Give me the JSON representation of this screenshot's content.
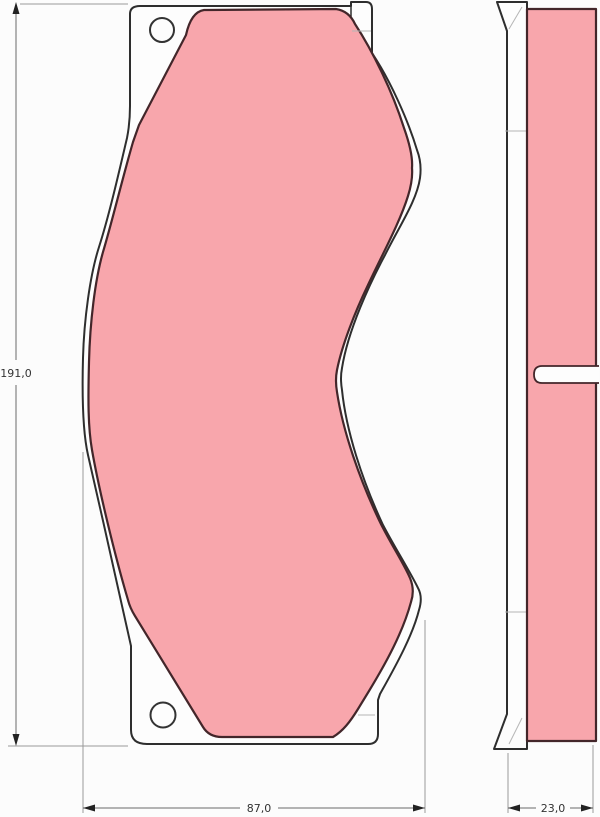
{
  "drawing": {
    "part": "disc-brake-pad-technical-drawing",
    "dimensions": {
      "height_mm": "191,0",
      "width_mm": "87,0",
      "thickness_mm": "23,0"
    },
    "colors": {
      "friction_material": "#f8a6ac",
      "friction_outline": "#43262a",
      "plate_outline": "#2e2e2e",
      "plate_fill": "#fdfdfd",
      "background": "#fcfcfc",
      "dimension_text": "#333333"
    }
  }
}
